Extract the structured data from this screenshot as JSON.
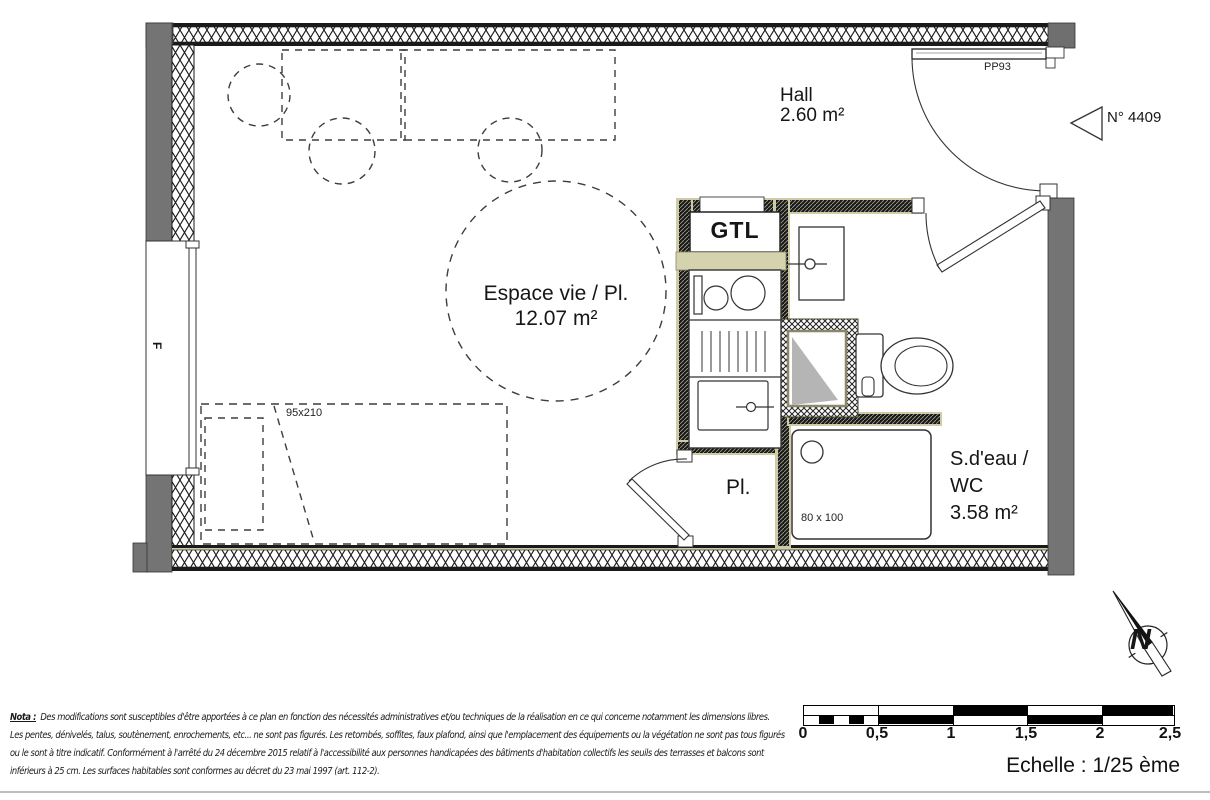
{
  "plan": {
    "rooms": {
      "hall": {
        "name": "Hall",
        "area": "2.60 m²"
      },
      "living": {
        "name": "Espace vie / Pl.",
        "area": "12.07 m²"
      },
      "bathroom": {
        "name_line1": "S.d'eau /",
        "name_line2": "WC",
        "area": "3.58 m²"
      },
      "closet": {
        "name": "Pl."
      },
      "gtl": {
        "name": "GTL"
      }
    },
    "annotations": {
      "entrance_door_ref": "PP93",
      "unit_ref": "N° 4409",
      "window_ref": "F",
      "bed_dimensions": "95x210",
      "shower_dimensions": "80 x 100",
      "north_label": "N"
    }
  },
  "scale_bar": {
    "ticks": [
      "0",
      "0,5",
      "1",
      "1,5",
      "2",
      "2,5"
    ],
    "caption": "Echelle : 1/25 ème"
  },
  "nota": {
    "prefix": "Nota :",
    "lines": [
      "Des modifications sont susceptibles d'être apportées à ce plan en fonction des nécessités administratives et/ou techniques de la réalisation en ce qui concerne notamment les dimensions libres.",
      "Les pentes, dénivelés, talus, soutènement, enrochements, etc... ne sont pas figurés. Les retombés, soffites, faux plafond, ainsi que l'emplacement des équipements ou la végétation ne sont pas tous figurés",
      "ou le sont à titre indicatif. Conformément à l'arrêté du 24 décembre 2015 relatif à l'accessibilité aux personnes handicapées des bâtiments d'habitation collectifs les seuils des terrasses et balcons sont",
      "inférieurs à 25 cm. Les surfaces habitables sont conformes au décret du 23 mai 1997 (art. 112-2)."
    ]
  },
  "colors": {
    "wall_gray": "#747474",
    "partition_beige": "#cfcba6",
    "kitchen_band_beige": "#d5d2ae",
    "fixture_gray": "#b5b5b5",
    "line_black": "#1a1a1a"
  }
}
